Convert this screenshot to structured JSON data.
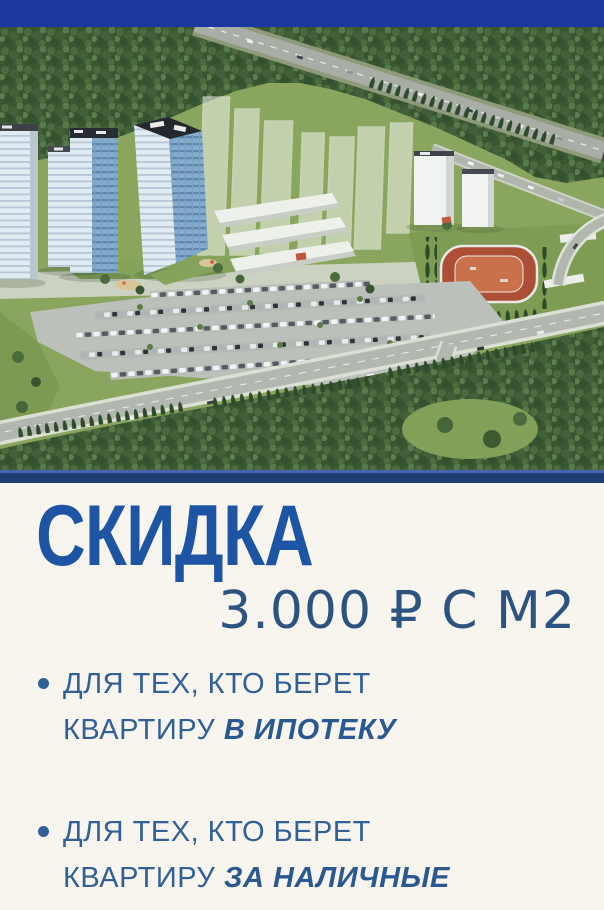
{
  "poster": {
    "headline": "СКИДКА",
    "price_line": "3.000 ₽ С М2",
    "bullets": [
      {
        "line1": "ДЛЯ ТЕХ, КТО БЕРЕТ",
        "line2": "КВАРТИРУ",
        "emphasis": "В ИПОТЕКУ"
      },
      {
        "line1": "ДЛЯ ТЕХ, КТО БЕРЕТ",
        "line2": "КВАРТИРУ",
        "emphasis": "ЗА НАЛИЧНЫЕ"
      }
    ],
    "image_alt": "Aerial render of a residential complex: high-rise towers, planned translucent buildings, stadium, parking lots, roads and surrounding forest"
  },
  "colors": {
    "top-band": "#1a38a0",
    "divider-line": "#4565ae",
    "divider-band": "#1f3e74",
    "background": "#f8f5ef",
    "headline": "#1d54a4",
    "price": "#2d5480",
    "bullet-text": "#316097",
    "bullet-emphasis": "#2a5890"
  }
}
